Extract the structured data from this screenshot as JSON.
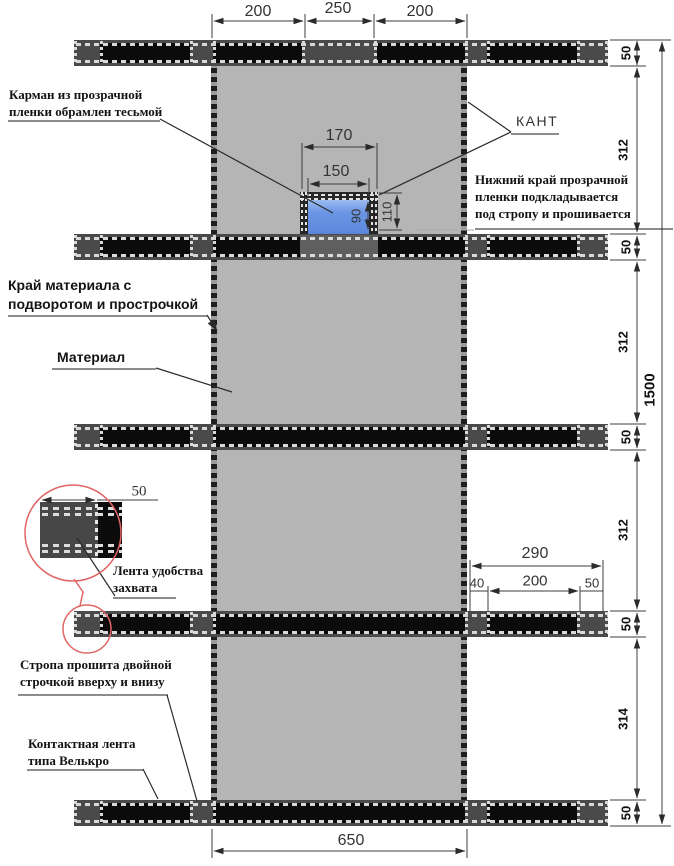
{
  "drawing": {
    "type": "technical-sewing-diagram",
    "language": "ru"
  },
  "annotations": {
    "pocket_label": [
      "Карман из прозрачной",
      "пленки обрамлен тесьмой"
    ],
    "kant": "КАНТ",
    "film_note": [
      "Нижний край прозрачной",
      "пленки подкладывается",
      "под стропу и прошивается"
    ],
    "edge_label": [
      "Край материала с",
      "подворотом и прострочкой"
    ],
    "material_label": "Материал",
    "grip_label": [
      "Лента удобства",
      "захвата"
    ],
    "strap_label": [
      "Стропа прошита двойной",
      "строчкой вверху и внизу"
    ],
    "velcro_label": [
      "Контактная лента",
      "типа Велькро"
    ]
  },
  "dimensions": {
    "top": [
      "200",
      "250",
      "200"
    ],
    "pocket_outer_width": "170",
    "pocket_inner_width": "150",
    "pocket_outer_height": "110",
    "pocket_inner_height": "90",
    "right_sequence": [
      "50",
      "312",
      "50",
      "312",
      "50",
      "312",
      "50",
      "314",
      "50"
    ],
    "overall_height": "1500",
    "strap_overhang_total": "290",
    "strap_overhang_parts": [
      "40",
      "200",
      "50"
    ],
    "bottom_width": "650",
    "detail_width": "50"
  },
  "colors": {
    "material_gray": "#b5b5b5",
    "strap_dark": "#4a4a4a",
    "strap_black": "#0b0b0b",
    "stitch_dash": "#d9d9d9",
    "pocket_blue": "#6b95e4",
    "detail_circle_red": "#e06565",
    "dim_line": "#3c3c3c"
  }
}
